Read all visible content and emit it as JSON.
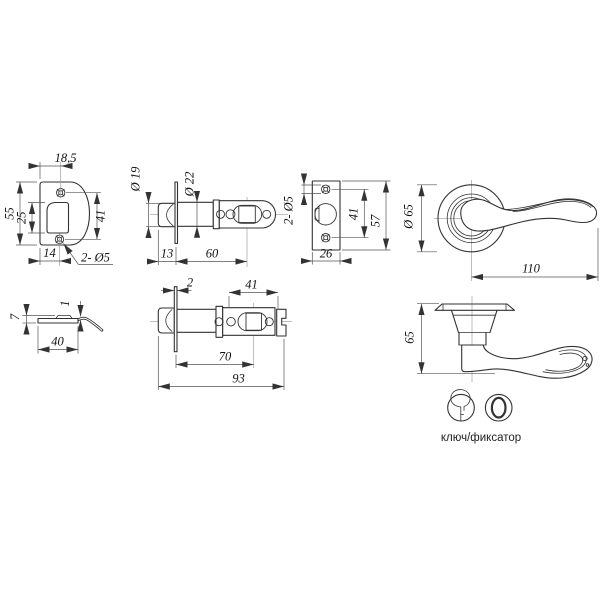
{
  "drawing_labels": {
    "strike_front": {
      "top_width": "18,5",
      "height": "55",
      "opening": "25",
      "holes_span": "41",
      "bottom_offset": "14",
      "holes_note": "2- Ø5"
    },
    "latch_backset60": {
      "bolt_diameter": "Ø 19",
      "tube_diameter": "Ø 22",
      "head_length": "13",
      "backset": "60"
    },
    "faceplate": {
      "holes_note": "2- Ø5",
      "holes_span": "41",
      "height": "57",
      "width": "26"
    },
    "handle_front": {
      "rose_diameter": "Ø 65",
      "lever_length": "110"
    },
    "strike_side": {
      "height": "7",
      "lip": "1",
      "width": "40"
    },
    "latch_backset70": {
      "flange": "2",
      "tail_length": "41",
      "backset": "70",
      "total_length": "93"
    },
    "handle_side": {
      "height": "65"
    },
    "legend": {
      "caption": "ключ/фиксатор"
    }
  }
}
